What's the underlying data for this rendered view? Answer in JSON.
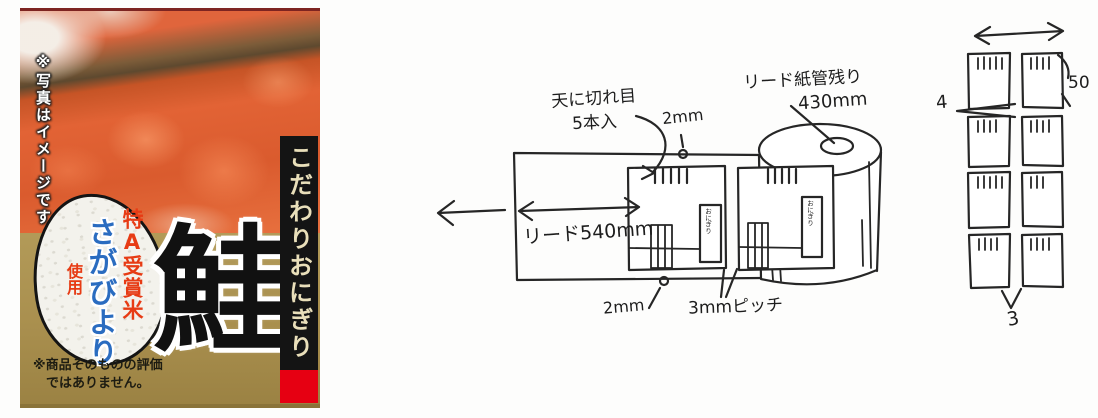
{
  "product_label": {
    "photo_note": "※写真はイメージです",
    "banner_text": "こだわりおにぎり",
    "product_name": "鮭",
    "rice_badge": {
      "award": "特A受賞米",
      "brand": "さがびより",
      "usage": "使用"
    },
    "disclaimer_line1": "※商品そのものの評価",
    "disclaimer_line2": "ではありません。",
    "colors": {
      "gold": "#ab9350",
      "banner_black": "#141414",
      "accent_red": "#e60012",
      "award_red": "#e73b14",
      "brand_blue": "#2a6cc0"
    }
  },
  "film_sketch": {
    "cut_note_line1": "天に切れ目",
    "cut_note_line2": "5本入",
    "top_gap": "2mm",
    "roll_note_line1": "リード紙管残り",
    "roll_note_line2": "430mm",
    "lead_length": "リード540mm",
    "bottom_gap": "2mm",
    "pitch": "3mmピッチ",
    "mini_package_label": "おにぎり"
  },
  "grid_sketch": {
    "height_label": "50",
    "gap_label": "4",
    "bottom_label": "3"
  }
}
